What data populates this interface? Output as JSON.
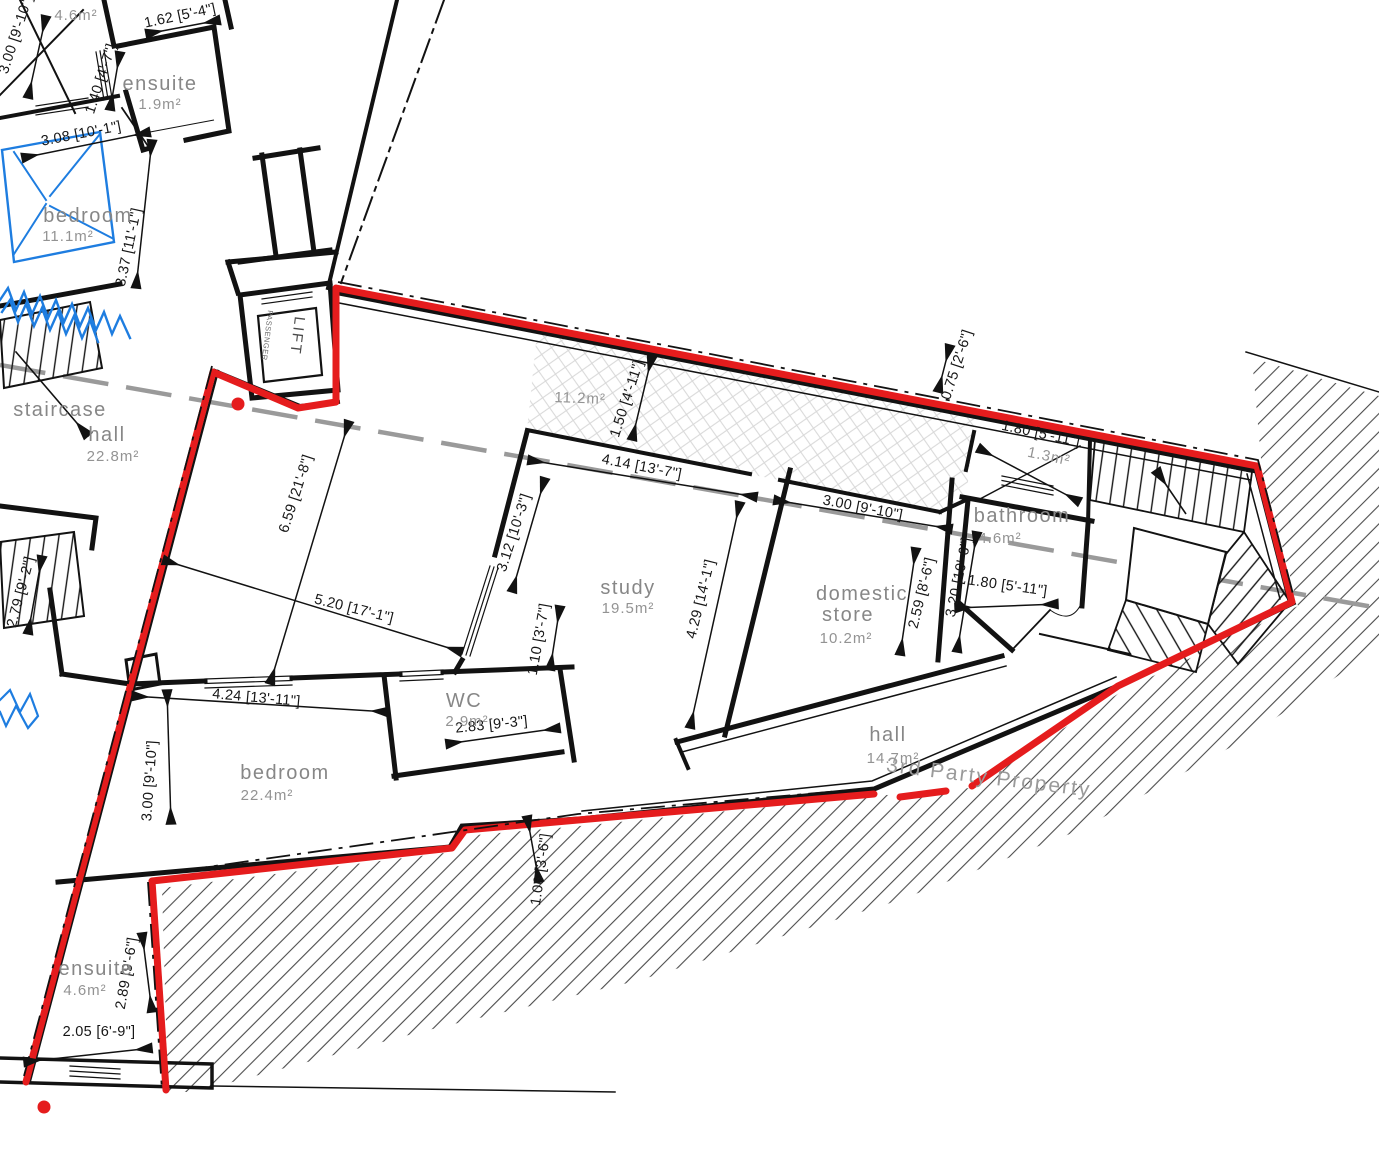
{
  "palette": {
    "boundary_red": "#e51c1d",
    "line_black": "#121212",
    "label_gray": "#878787",
    "furniture_blue": "#1e7de0",
    "dash_gray": "#9a9a9a"
  },
  "annotations": {
    "third_party": "3rd Party Property"
  },
  "lift": {
    "label": "LIFT",
    "sublabel": "PASSENGER"
  },
  "rooms": [
    {
      "name": "ensuite",
      "area": "1.9m²"
    },
    {
      "name": "bedroom",
      "area": "11.1m²"
    },
    {
      "name": "staircase",
      "area": ""
    },
    {
      "name": "hall",
      "area": "22.8m²"
    },
    {
      "name": "",
      "area": "4.6m²"
    },
    {
      "name": "",
      "area": "11.2m²"
    },
    {
      "name": "study",
      "area": "19.5m²"
    },
    {
      "name1": "domestic",
      "name2": "store",
      "area": "10.2m²"
    },
    {
      "name": "bathroom",
      "area": "4.6m²"
    },
    {
      "name": "",
      "area": "1.3m²"
    },
    {
      "name": "hall",
      "area": "14.7m²"
    },
    {
      "name": "bedroom",
      "area": "22.4m²"
    },
    {
      "name": "WC",
      "area": "2.9m²"
    },
    {
      "name": "ensuite",
      "area": "4.6m²"
    }
  ],
  "dimensions": [
    {
      "text": "3.00 [9'-10\"]"
    },
    {
      "text": "1.62 [5'-4\"]"
    },
    {
      "text": "1.40 [4'-7\"]"
    },
    {
      "text": "3.08 [10'-1\"]"
    },
    {
      "text": "3.37 [11'-1\"]"
    },
    {
      "text": "2.79 [9'-2\"]"
    },
    {
      "text": "6.59 [21'-8\"]"
    },
    {
      "text": "5.20 [17'-1\"]"
    },
    {
      "text": "3.12 [10'-3\"]"
    },
    {
      "text": "1.10 [3'-7\"]"
    },
    {
      "text": "4.24 [13'-11\"]"
    },
    {
      "text": "2.83 [9'-3\"]"
    },
    {
      "text": "3.00 [9'-10\"]"
    },
    {
      "text": "1.50 [4'-11\"]"
    },
    {
      "text": "4.14 [13'-7\"]"
    },
    {
      "text": "3.00 [9'-10\"]"
    },
    {
      "text": "4.29 [14'-1\"]"
    },
    {
      "text": "2.59 [8'-6\"]"
    },
    {
      "text": "3.20 [10'-6\"]"
    },
    {
      "text": "0.75 [2'-6\"]"
    },
    {
      "text": "1.80 [5'-11\"]"
    },
    {
      "text": "1.80 [5'-11\"]"
    },
    {
      "text": "1.06 [3'-6\"]"
    },
    {
      "text": "2.89 [9'-6\"]"
    },
    {
      "text": "2.05 [6'-9\"]"
    }
  ]
}
